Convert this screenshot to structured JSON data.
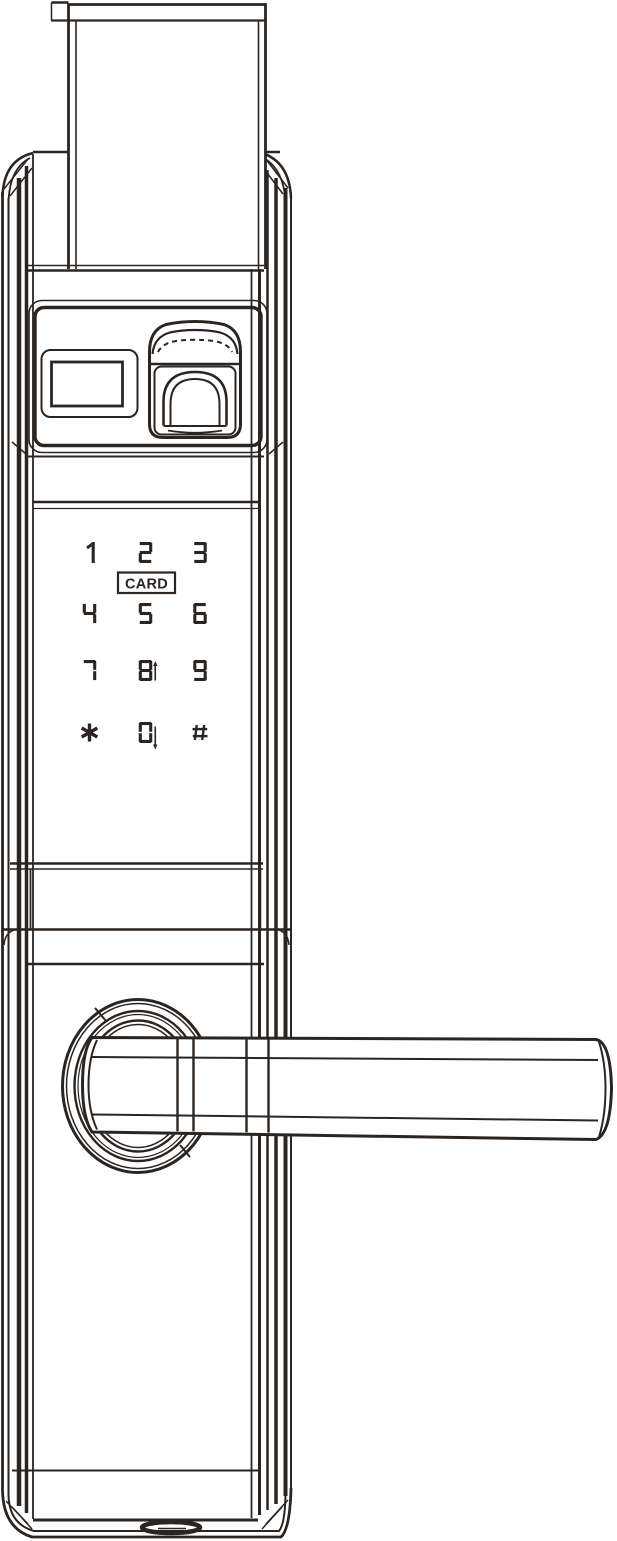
{
  "colors": {
    "line": "#2b2522",
    "background": "#ffffff"
  },
  "keypad": {
    "card_label": "CARD",
    "keys": [
      {
        "label": "1"
      },
      {
        "label": "2"
      },
      {
        "label": "3"
      },
      {
        "label": "4"
      },
      {
        "label": "5"
      },
      {
        "label": "6"
      },
      {
        "label": "7"
      },
      {
        "label": "8",
        "arrow": "↑"
      },
      {
        "label": "9"
      },
      {
        "label": "*"
      },
      {
        "label": "0",
        "arrow": "↓"
      },
      {
        "label": "#"
      }
    ]
  }
}
